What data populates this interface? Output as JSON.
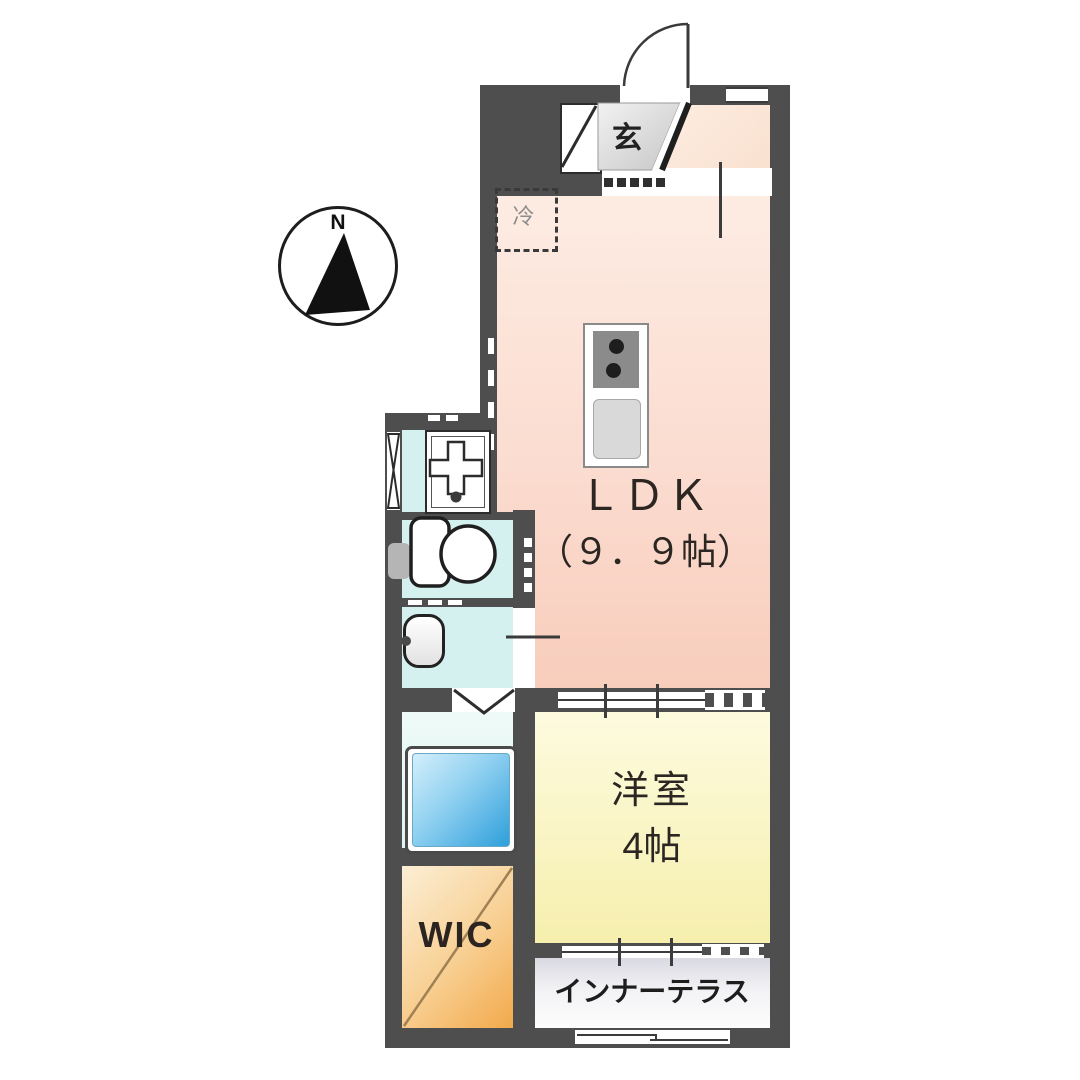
{
  "title": "apartment-floor-plan",
  "compass": {
    "label": "N"
  },
  "rooms": {
    "entrance": {
      "label": "玄"
    },
    "fridge": {
      "label": "冷"
    },
    "ldk": {
      "label": "ＬＤＫ",
      "size": "（９．９帖）"
    },
    "western_room": {
      "label": "洋室",
      "size": "4帖"
    },
    "wic": {
      "label": "WIC"
    },
    "inner_terrace": {
      "label": "インナーテラス"
    }
  },
  "colors": {
    "wall": "#4e4e4e",
    "ldk": "#f8cdbc",
    "western_room": "#f6efad",
    "wic": "#f2a94b",
    "wet_area": "#d4f0ef",
    "bathtub": "#2e9fdb",
    "terrace": "#d9d9e2",
    "entrance_floor": "#d6d6d6"
  }
}
